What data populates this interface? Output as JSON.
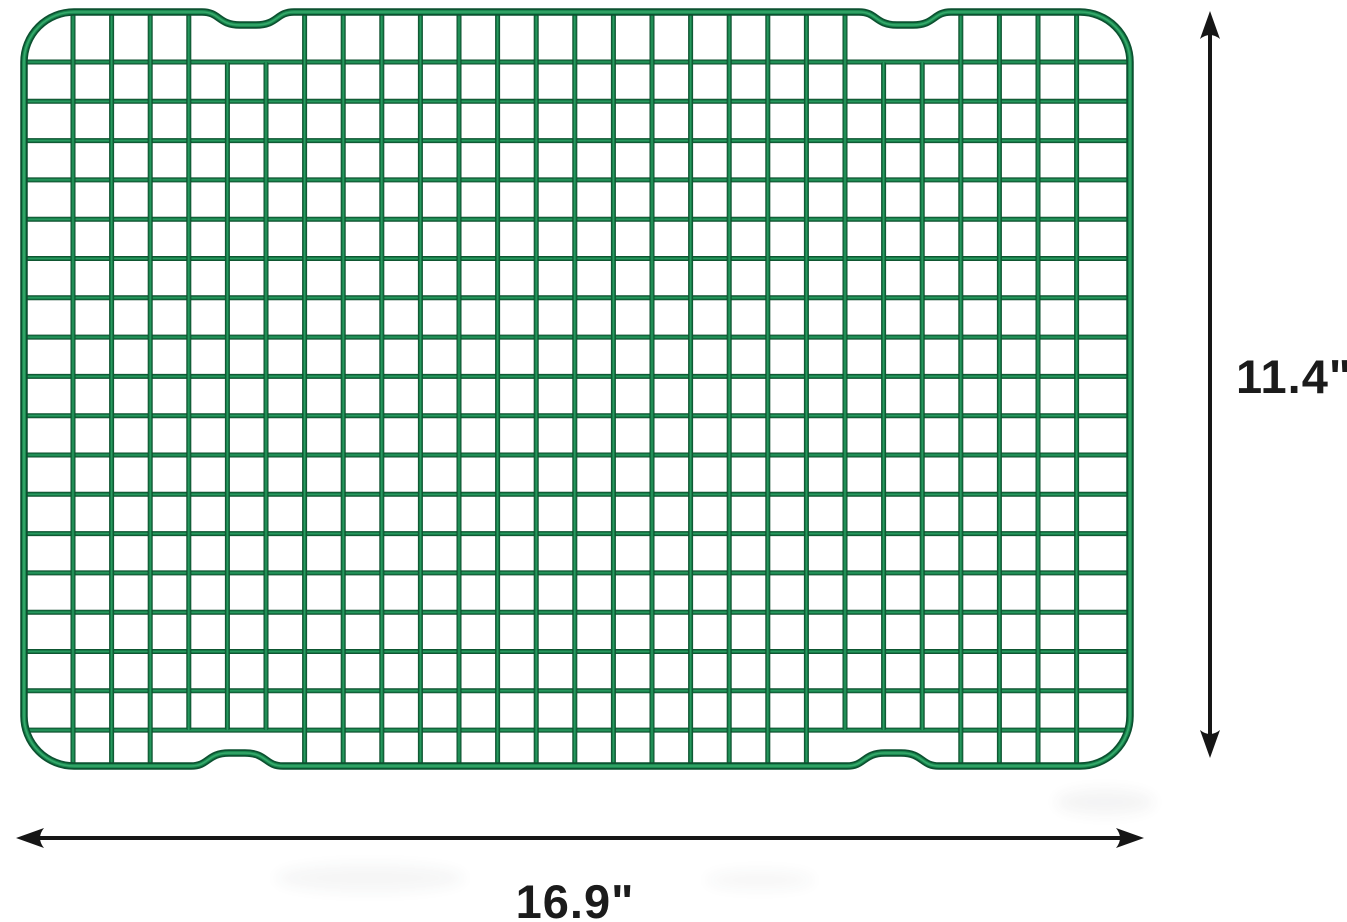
{
  "image_type": "product-dimension-diagram",
  "background_color": "#ffffff",
  "product": {
    "name": "green-wire-cooling-rack",
    "colors": {
      "wire_dark": "#0b4427",
      "wire_mid": "#17804a",
      "wire_bright": "#2fa368",
      "frame_dark": "#0c5130",
      "frame_mid": "#1a8a50",
      "frame_bright": "#37aa6c"
    },
    "frame": {
      "left": 24,
      "right": 1130,
      "top": 12,
      "bottom": 766,
      "corner_radius": 50,
      "stroke_width": 7.5
    },
    "grid": {
      "col_start": 73,
      "col_step": 38.6,
      "col_count": 27,
      "row_start": 62,
      "row_step": 39.3,
      "row_count": 18,
      "wire_thickness": 5
    },
    "notches": {
      "half_width": 46,
      "depth": 13,
      "top_centers": [
        248,
        905
      ],
      "bottom_centers": [
        237,
        893
      ],
      "skip_top_columns": [
        4,
        5,
        21,
        22
      ],
      "skip_bottom_columns": [
        3,
        4,
        5,
        20,
        21,
        22
      ]
    },
    "shadows": [
      {
        "cx": 370,
        "cy": 878,
        "rx": 95,
        "ry": 14,
        "opacity": 0.045
      },
      {
        "cx": 760,
        "cy": 880,
        "rx": 55,
        "ry": 10,
        "opacity": 0.035
      },
      {
        "cx": 1105,
        "cy": 802,
        "rx": 50,
        "ry": 13,
        "opacity": 0.05
      }
    ]
  },
  "dimensions": {
    "arrow_color": "#161616",
    "arrow_line_width": 4,
    "height": {
      "label": "11.4\"",
      "line_x": 1210,
      "y1": 11,
      "y2": 758
    },
    "width": {
      "label": "16.9\"",
      "line_y": 838,
      "x1": 16,
      "x2": 1144
    }
  }
}
